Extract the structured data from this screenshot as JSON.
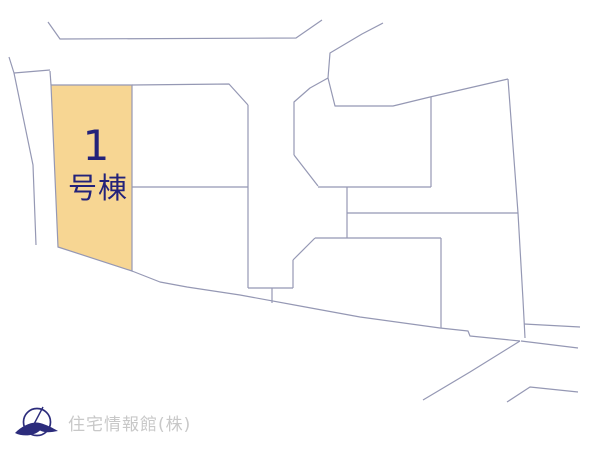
{
  "page": {
    "background": "#ffffff"
  },
  "map": {
    "line_color": "#9598b4",
    "line_width": 1.2,
    "lines": [
      "48,22 60,39 296,38 322,20",
      "383,23 362,34 330,53 328,78",
      "9,57 14,73 50,70",
      "14,73 33,165 36,245",
      "50,71 51,85",
      "132,85 229,84 248,105",
      "248,105 248,288",
      "132,187 248,187",
      "248,288 293,288",
      "293,260 293,288",
      "272,288 272,303",
      "293,260 315,238",
      "315,238 441,238",
      "441,238 441,328",
      "294,155 294,102 310,88 328,78",
      "294,155 318,186",
      "318,187 431,187",
      "347,187 347,238",
      "347,213 518,213",
      "328,78 335,106 393,106 430,97 508,79",
      "431,97 431,187",
      "508,79 518,213 523,300 525,338",
      "132,271 160,282 187,287 240,295 300,306 360,317 440,328 468,331 470,336 520,341",
      "524,324 580,327",
      "521,341 578,348",
      "520,341 470,372 423,400",
      "507,402 530,387 578,392"
    ],
    "highlight_lot": {
      "points": "51,85 132,85 132,271 58,247",
      "fill": "#f7d693",
      "stroke": "#9598b4",
      "label_number": "1",
      "label_suffix": "号棟",
      "label_color": "#23227a"
    }
  },
  "footer": {
    "company": "住宅情報館(株)",
    "text_color": "#c8c8c8",
    "logo": "crane-circle-logo",
    "logo_color": "#2c2c7c"
  }
}
